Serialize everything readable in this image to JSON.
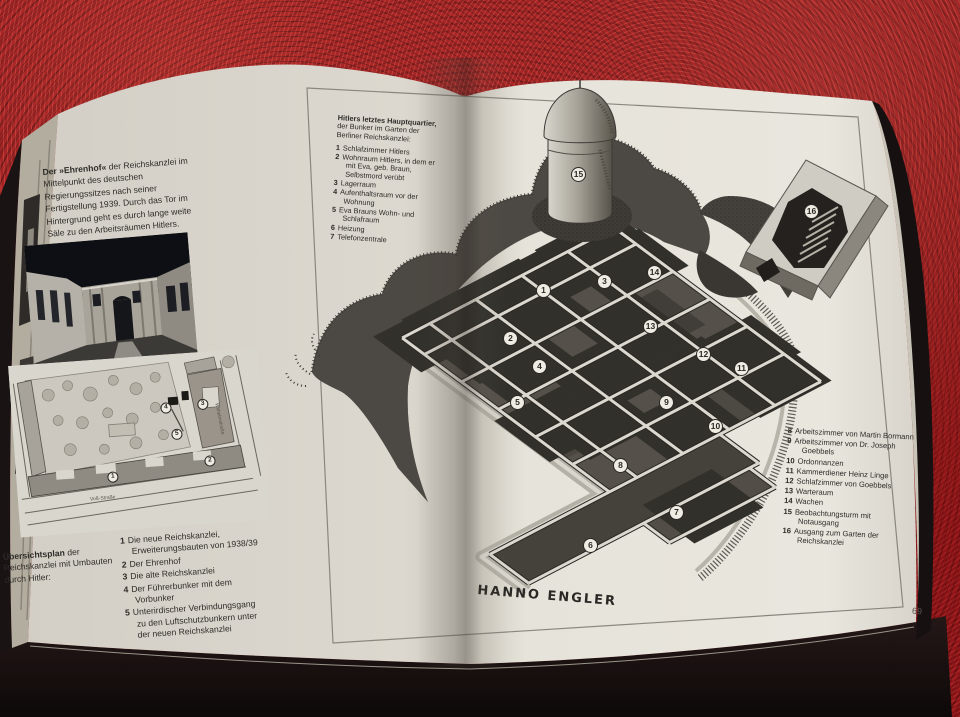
{
  "book": {
    "page_number": "69",
    "signature": "HANNO ENGLER"
  },
  "left_page": {
    "photo_caption": {
      "lead": "Der »Ehrenhof«",
      "rest": " der Reichskanzlei im Mittelpunkt des deutschen Regierungssitzes nach seiner Fertigstellung 1939. Durch das Tor im Hintergrund geht es durch lange weite Säle zu den Arbeitsräumen Hitlers."
    },
    "map": {
      "street_bottom": "Voß-Straße",
      "street_right": "Wilhelmstraße",
      "markers": [
        {
          "n": "1",
          "x": 97,
          "y": 119
        },
        {
          "n": "2",
          "x": 195,
          "y": 110
        },
        {
          "n": "3",
          "x": 192,
          "y": 53
        },
        {
          "n": "4",
          "x": 155,
          "y": 54
        },
        {
          "n": "5",
          "x": 164,
          "y": 81
        }
      ]
    },
    "map_legend": {
      "lead": "Übersichtsplan",
      "rest": " der Reichskanzlei mit Umbauten durch Hitler:",
      "items": [
        {
          "n": "1",
          "text": "Die neue Reichskanzlei, Erweiterungsbauten von 1938/39"
        },
        {
          "n": "2",
          "text": "Der Ehrenhof"
        },
        {
          "n": "3",
          "text": "Die alte Reichskanzlei"
        },
        {
          "n": "4",
          "text": "Der Führerbunker mit dem Vorbunker"
        },
        {
          "n": "5",
          "text": "Unterirdischer Verbindungsgang zu den Luftschutzbunkern unter der neuen Reichskanzlei"
        }
      ]
    }
  },
  "figure": {
    "legend_top": {
      "lead": "Hitlers letztes Hauptquartier,",
      "rest": " der Bunker im Garten der Berliner Reichskanzlei:",
      "items": [
        {
          "n": "1",
          "text": "Schlafzimmer Hitlers"
        },
        {
          "n": "2",
          "text": "Wohnraum Hitlers, in dem er mit Eva, geb. Braun, Selbstmord verübt"
        },
        {
          "n": "3",
          "text": "Lagerraum"
        },
        {
          "n": "4",
          "text": "Aufenthaltsraum vor der Wohnung"
        },
        {
          "n": "5",
          "text": "Eva Brauns Wohn- und Schlafraum"
        },
        {
          "n": "6",
          "text": "Heizung"
        },
        {
          "n": "7",
          "text": "Telefonzentrale"
        }
      ]
    },
    "legend_right": {
      "items": [
        {
          "n": "8",
          "text": "Arbeitszimmer von Martin Bormann"
        },
        {
          "n": "9",
          "text": "Arbeitszimmer von Dr. Joseph Goebbels"
        },
        {
          "n": "10",
          "text": "Ordonnanzen"
        },
        {
          "n": "11",
          "text": "Kammerdiener Heinz Linge"
        },
        {
          "n": "12",
          "text": "Schlafzimmer von Goebbels"
        },
        {
          "n": "13",
          "text": "Warteraum"
        },
        {
          "n": "14",
          "text": "Wachen"
        },
        {
          "n": "15",
          "text": "Beobachtungsturm mit Notausgang"
        },
        {
          "n": "16",
          "text": "Ausgang zum Garten der Reichskanzlei"
        }
      ]
    },
    "markers": [
      {
        "n": "1",
        "x": 544,
        "y": 291
      },
      {
        "n": "2",
        "x": 511,
        "y": 339
      },
      {
        "n": "3",
        "x": 605,
        "y": 282
      },
      {
        "n": "4",
        "x": 540,
        "y": 367
      },
      {
        "n": "5",
        "x": 518,
        "y": 403
      },
      {
        "n": "6",
        "x": 591,
        "y": 546
      },
      {
        "n": "7",
        "x": 677,
        "y": 513
      },
      {
        "n": "8",
        "x": 621,
        "y": 466
      },
      {
        "n": "9",
        "x": 667,
        "y": 403
      },
      {
        "n": "10",
        "x": 716,
        "y": 427
      },
      {
        "n": "11",
        "x": 742,
        "y": 369
      },
      {
        "n": "12",
        "x": 704,
        "y": 355
      },
      {
        "n": "13",
        "x": 651,
        "y": 327
      },
      {
        "n": "14",
        "x": 655,
        "y": 273
      },
      {
        "n": "15",
        "x": 579,
        "y": 175
      },
      {
        "n": "16",
        "x": 812,
        "y": 212
      }
    ]
  }
}
